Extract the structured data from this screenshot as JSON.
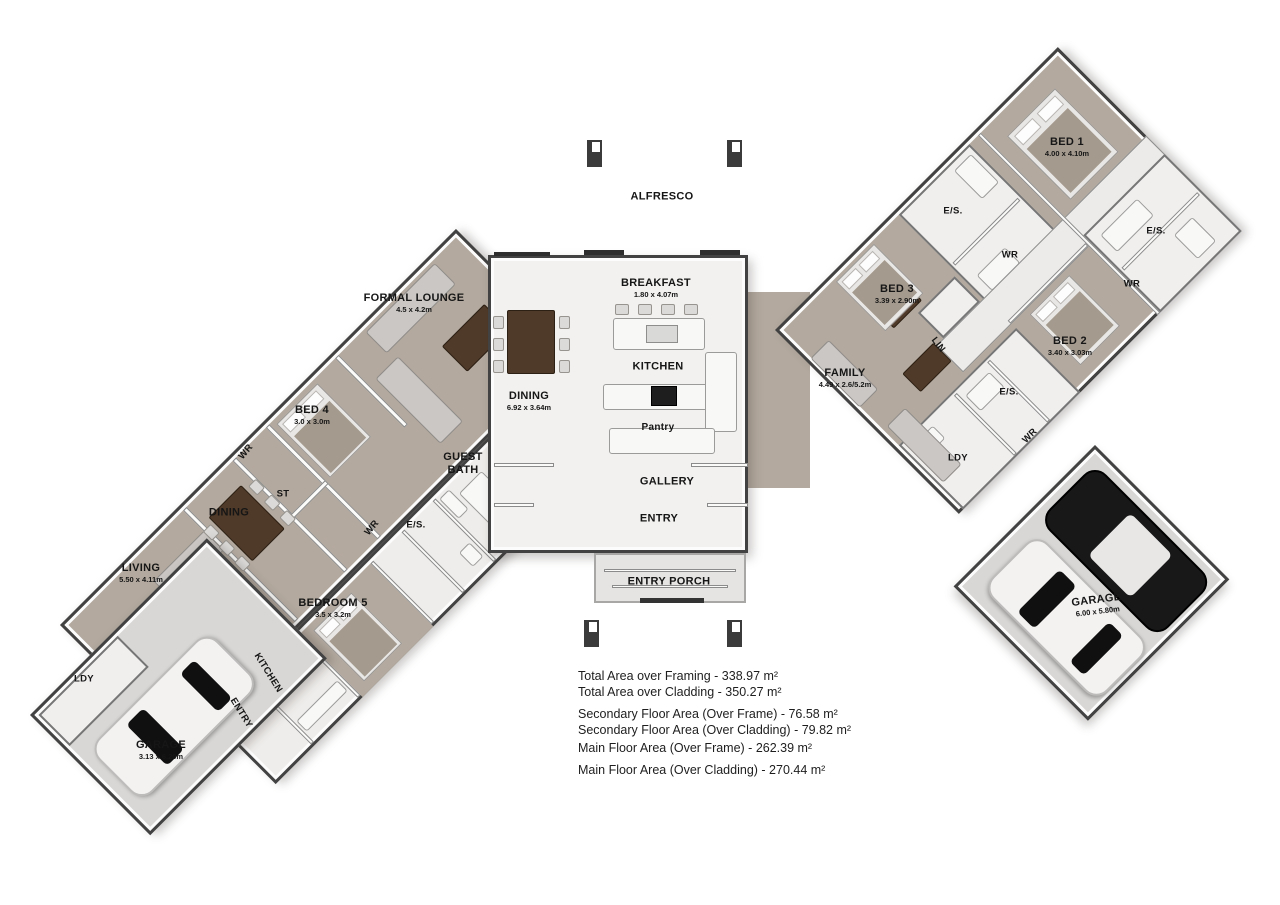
{
  "plan": {
    "labels": {
      "alfresco": {
        "name": "ALFRESCO"
      },
      "breakfast": {
        "name": "BREAKFAST",
        "dims": "1.80 x 4.07m"
      },
      "kitchen_main": {
        "name": "KITCHEN"
      },
      "dining_main": {
        "name": "DINING",
        "dims": "6.92 x 3.64m"
      },
      "pantry": {
        "name": "Pantry"
      },
      "gallery": {
        "name": "GALLERY"
      },
      "entry_main": {
        "name": "ENTRY"
      },
      "entry_porch": {
        "name": "ENTRY PORCH"
      },
      "formal_lounge": {
        "name": "FORMAL LOUNGE",
        "dims": "4.5 x 4.2m"
      },
      "bed4": {
        "name": "BED 4",
        "dims": "3.0 x 3.0m"
      },
      "wr_bed4": {
        "name": "WR"
      },
      "st": {
        "name": "ST"
      },
      "dining_left": {
        "name": "DINING"
      },
      "living": {
        "name": "LIVING",
        "dims": "5.50 x 4.11m"
      },
      "guest_bath": {
        "name": "GUEST BATH"
      },
      "es_guest": {
        "name": "E/S."
      },
      "wr_guest": {
        "name": "WR"
      },
      "bedroom5": {
        "name": "BEDROOM 5",
        "dims": "3.5 x 3.2m"
      },
      "ldy_left": {
        "name": "LDY"
      },
      "kitchen_left": {
        "name": "KITCHEN"
      },
      "entry_left": {
        "name": "ENTRY"
      },
      "garage_left": {
        "name": "GARAGE",
        "dims": "3.13 x 6.20m"
      },
      "family": {
        "name": "FAMILY",
        "dims": "4.49 x 2.6/5.2m"
      },
      "bed3": {
        "name": "BED 3",
        "dims": "3.39 x 2.90m"
      },
      "es_bed3": {
        "name": "E/S."
      },
      "wr_bed3": {
        "name": "WR"
      },
      "lin": {
        "name": "LIN"
      },
      "bed1": {
        "name": "BED 1",
        "dims": "4.00 x 4.10m"
      },
      "es_bed1": {
        "name": "E/S."
      },
      "wr_bed1": {
        "name": "WR"
      },
      "bed2": {
        "name": "BED 2",
        "dims": "3.40 x 3.03m"
      },
      "es_bed2": {
        "name": "E/S."
      },
      "wr_bed2": {
        "name": "WR"
      },
      "ldy_right": {
        "name": "LDY"
      },
      "garage_right": {
        "name": "GARAGE",
        "dims": "6.00 x 5.80m"
      }
    },
    "area_summary": [
      "Total Area over Framing - 338.97 m²",
      "Total Area over Cladding - 350.27 m²",
      "Secondary Floor Area (Over Frame) - 76.58 m²",
      "Secondary Floor Area (Over Cladding) - 79.82 m²",
      "Main Floor Area (Over Frame) - 262.39 m²",
      "Main Floor Area (Over Cladding) - 270.44 m²"
    ],
    "colors": {
      "carpet": "#b3a99e",
      "hard_floor": "#f0efed",
      "concrete": "#d8d7d5",
      "wall": "#424242",
      "timber": "#4f3928",
      "car_black": "#181818",
      "car_white": "#f3f2f1"
    }
  }
}
